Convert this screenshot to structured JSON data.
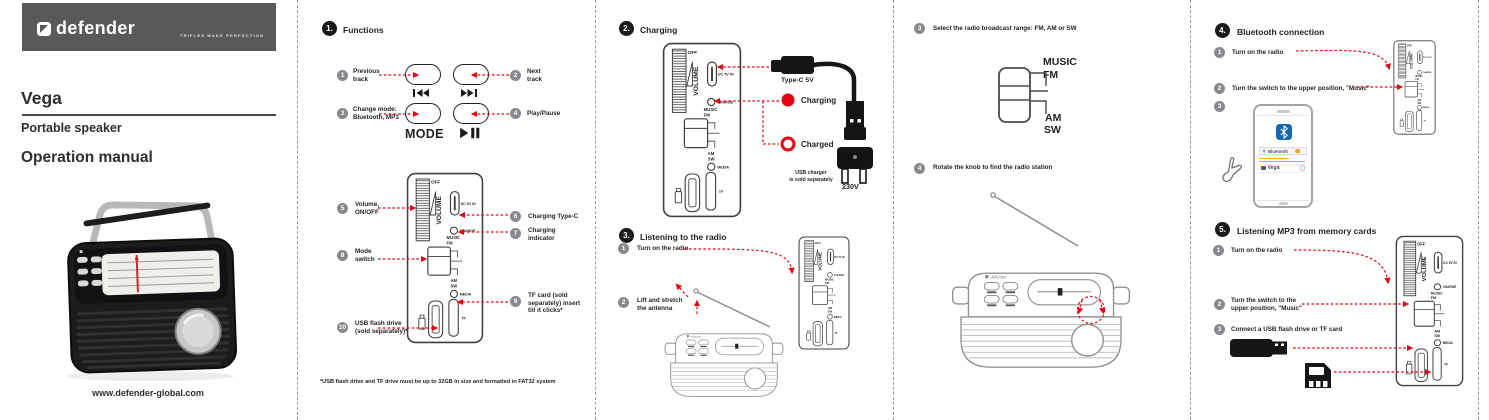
{
  "colors": {
    "accent_red": "#e30613",
    "header_gray": "#58595b",
    "callout_gray": "#87898c",
    "bt_blue": "#1467b3",
    "toggle_orange": "#f5a623"
  },
  "brand": {
    "logo_text": "defender",
    "tagline": "TRIFLES MAKE PERFECTION",
    "product_name": "Vega",
    "product_type": "Portable speaker",
    "doc_title": "Operation manual",
    "website": "www.defender-global.com"
  },
  "panel_labels": {
    "off": "OFF",
    "volume": "VOLUME",
    "dc_in": "DC 5V IN",
    "charge": "CHARGE",
    "music": "MUSIC",
    "fm": "FM",
    "am": "AM",
    "sw": "SW",
    "media": "MEDIA",
    "tf": "TF"
  },
  "functions": {
    "number": "1.",
    "title": "Functions",
    "controls": {
      "mode": "MODE"
    },
    "callouts": [
      {
        "num": "1",
        "label": "Previous\ntrack"
      },
      {
        "num": "2",
        "label": "Next\ntrack"
      },
      {
        "num": "3",
        "label": "Change mode:\nBluetooth, MP3"
      },
      {
        "num": "4",
        "label": "Play/Pause"
      },
      {
        "num": "5",
        "label": "Volume,\nON/OFF"
      },
      {
        "num": "6",
        "label": "Charging Type-C"
      },
      {
        "num": "7",
        "label": "Charging\nindicator"
      },
      {
        "num": "8",
        "label": "Mode\nswitch"
      },
      {
        "num": "9",
        "label": "TF card (sold\nseparately) insert\ntill it clicks*"
      },
      {
        "num": "10",
        "label": "USB flash drive\n(sold separately)*"
      }
    ],
    "footnote": "*USB flash drive and TF drive must be up to 32GB in size and formatted in FAT32 system"
  },
  "charging": {
    "number": "2.",
    "title": "Charging",
    "cable_label": "Type-C 5V",
    "state_charging": "Charging",
    "state_charged": "Charged",
    "charger_note": "USB charger\nis sold separately",
    "voltage": "230V"
  },
  "listening_radio": {
    "number": "3.",
    "title": "Listening to the radio",
    "steps": [
      {
        "num": "1",
        "label": "Turn on the radio"
      },
      {
        "num": "2",
        "label": "Lift and stretch\nthe antenna"
      }
    ]
  },
  "radio_tuning": {
    "step_select": {
      "num": "3",
      "label": "Select the radio broadcast range: FM, AM or SW"
    },
    "step_rotate": {
      "num": "4",
      "label": "Rotate the knob to find the radio station"
    }
  },
  "bluetooth": {
    "number": "4.",
    "title": "Bluetooth connection",
    "steps": [
      {
        "num": "1",
        "label": "Turn on the radio"
      },
      {
        "num": "2",
        "label": "Turn the switch to the upper position, \"Music\""
      },
      {
        "num": "3",
        "label": ""
      }
    ],
    "phone": {
      "bluetooth_row": "Bluetooth",
      "device_name": "Vega"
    }
  },
  "mp3": {
    "number": "5.",
    "title": "Listening MP3 from memory cards",
    "steps": [
      {
        "num": "1",
        "label": "Turn on the radio"
      },
      {
        "num": "2",
        "label": "Turn the switch to the\nupper position, \"Music\""
      },
      {
        "num": "3",
        "label": "Connect a USB flash drive or TF card"
      }
    ]
  }
}
